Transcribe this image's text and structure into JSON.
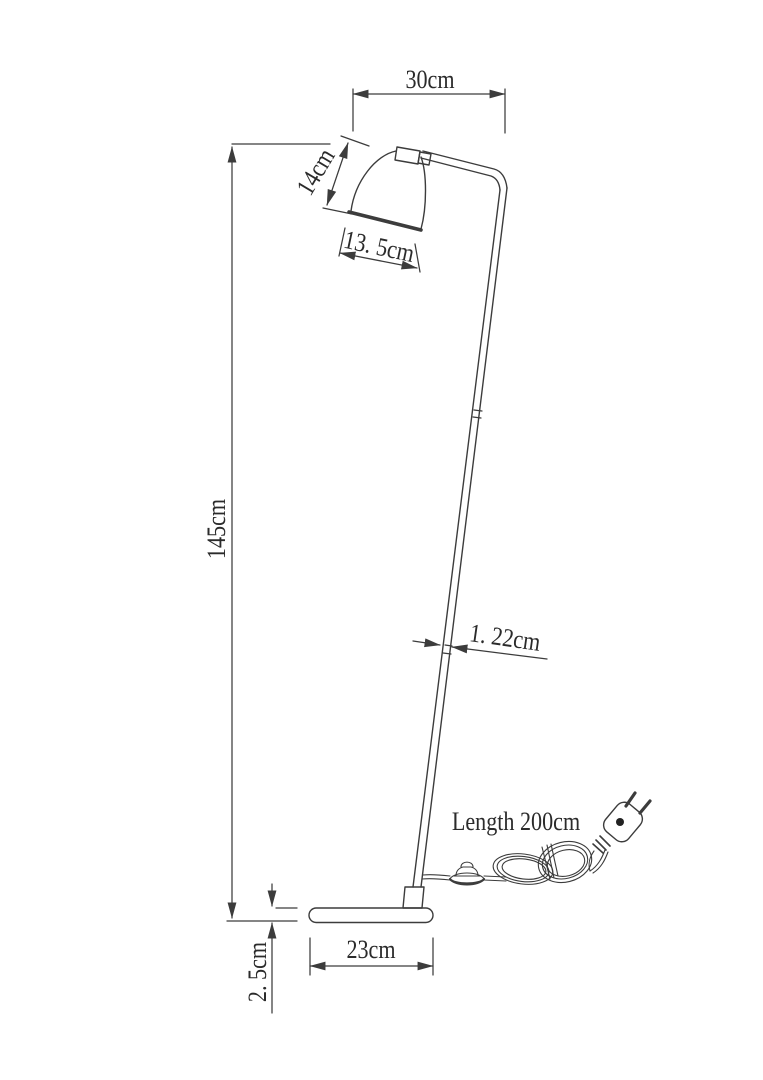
{
  "labels": {
    "arm_reach": "30cm",
    "shade_height": "14cm",
    "shade_width": "13. 5cm",
    "total_height": "145cm",
    "pole_diameter": "1. 22cm",
    "cord_length": "Length 200cm",
    "base_width": "23cm",
    "base_thickness": "2. 5cm"
  },
  "colors": {
    "line": "#3c3c3c",
    "text": "#2b2b2b",
    "background": "#ffffff"
  }
}
